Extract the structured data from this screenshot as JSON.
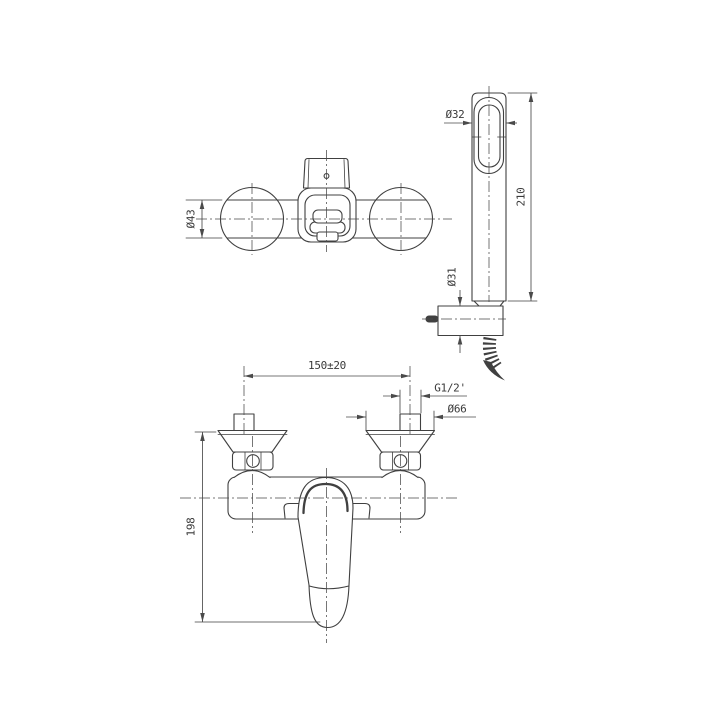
{
  "canvas": {
    "background_color": "#ffffff",
    "line_color": "#404040",
    "text_color": "#3a3a3a"
  },
  "views": {
    "top": {
      "dims": {
        "body_diameter": "Ø43"
      }
    },
    "hand_shower": {
      "dims": {
        "head_diameter": "Ø32",
        "length": "210",
        "bracket_diameter": "Ø31"
      }
    },
    "front": {
      "dims": {
        "inlet_spacing": "150±20",
        "thread_size": "G1/2'",
        "flange_diameter": "Ø66",
        "overall_height": "198"
      }
    }
  }
}
